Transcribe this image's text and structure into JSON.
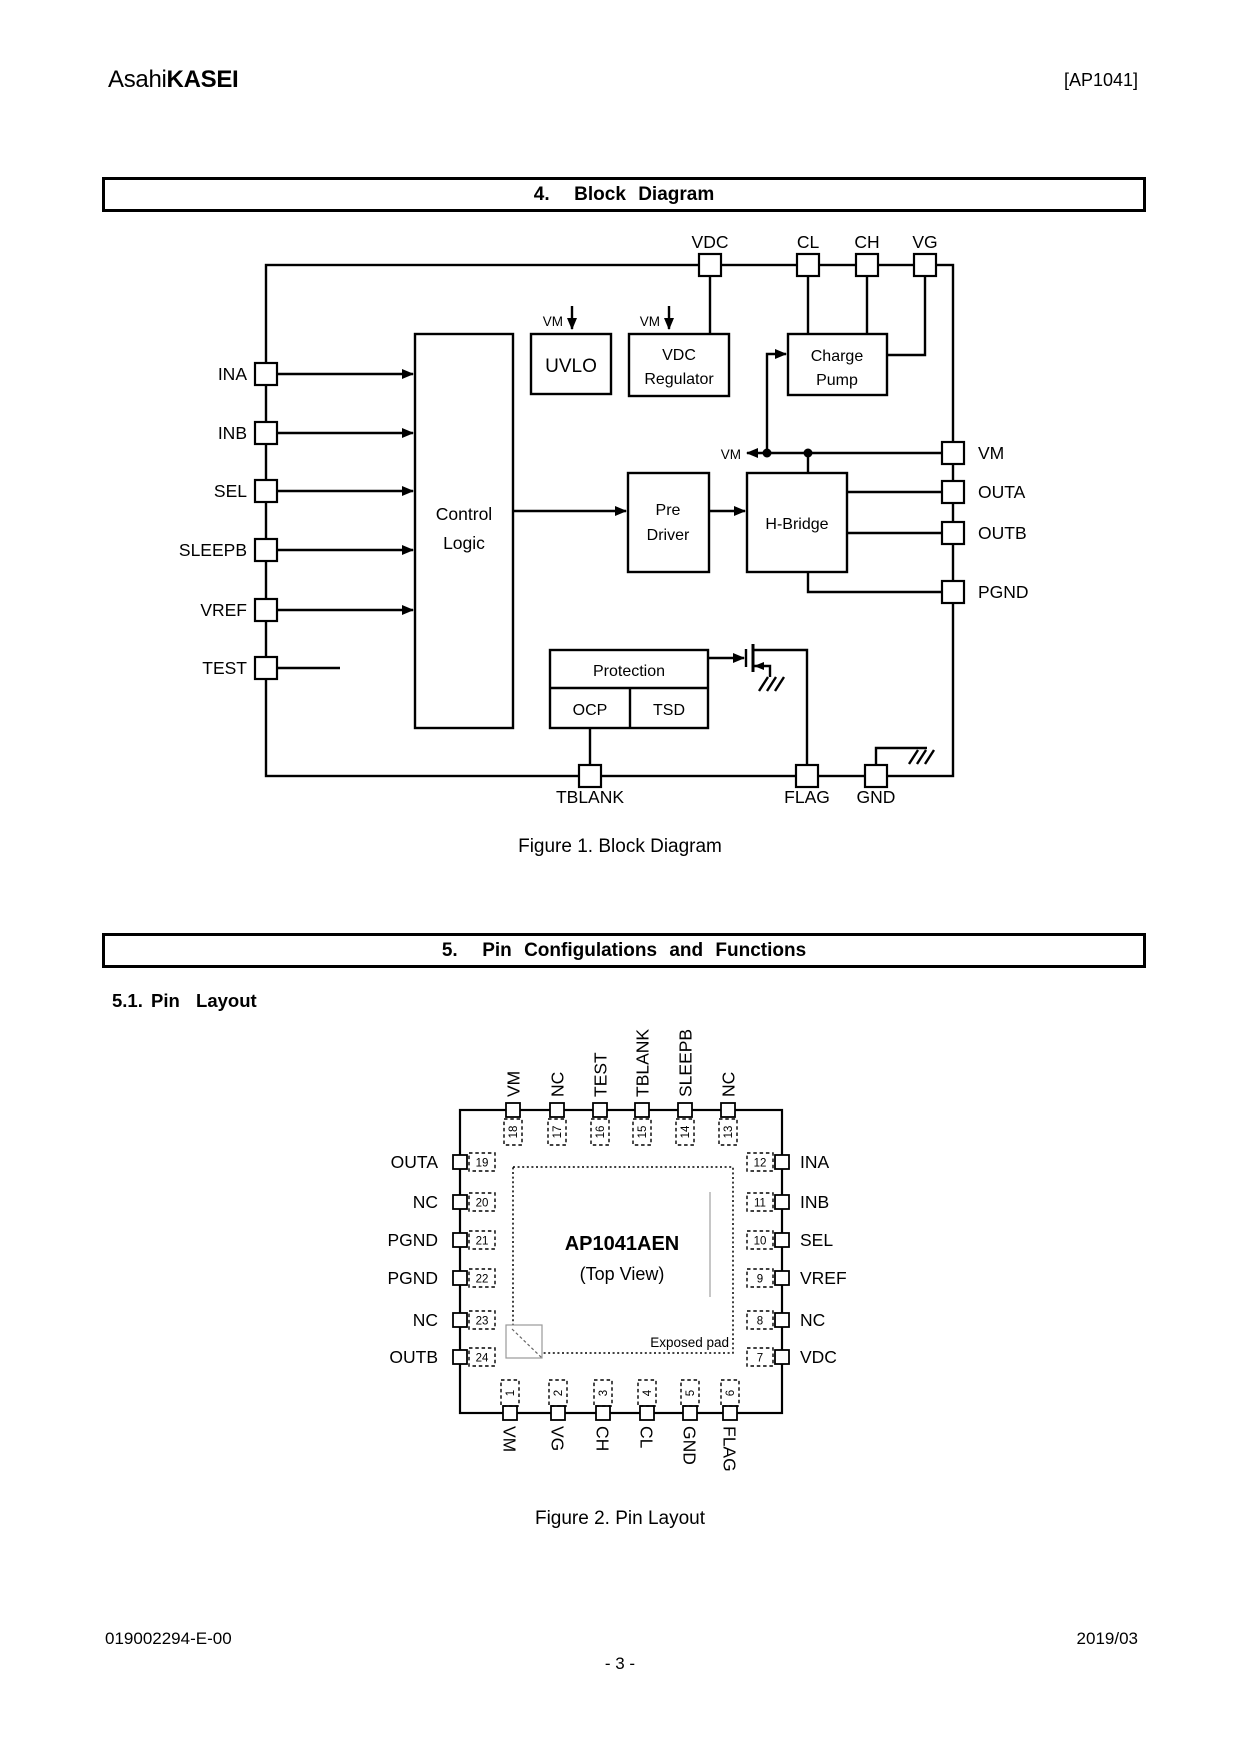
{
  "header": {
    "brand_light": "Asahi",
    "brand_bold": "KASEI",
    "doc_id": "[AP1041]"
  },
  "section4": {
    "title": "4.  Block Diagram"
  },
  "figure1": {
    "caption": "Figure 1. Block Diagram",
    "vm": "VM",
    "pins": {
      "top": [
        "VDC",
        "CL",
        "CH",
        "VG"
      ],
      "left": [
        "INA",
        "INB",
        "SEL",
        "SLEEPB",
        "VREF",
        "TEST"
      ],
      "right": [
        "VM",
        "OUTA",
        "OUTB",
        "PGND"
      ],
      "bottom": [
        "TBLANK",
        "FLAG",
        "GND"
      ]
    },
    "blocks": {
      "control1": "Control",
      "control2": "Logic",
      "uvlo": "UVLO",
      "vdcreg1": "VDC",
      "vdcreg2": "Regulator",
      "pump1": "Charge",
      "pump2": "Pump",
      "pre1": "Pre",
      "pre2": "Driver",
      "hbridge": "H-Bridge",
      "protection": "Protection",
      "ocp": "OCP",
      "tsd": "TSD"
    }
  },
  "section5": {
    "title": "5.  Pin Configulations and Functions",
    "subtitle": "5.1. Pin  Layout"
  },
  "figure2": {
    "caption": "Figure 2. Pin Layout",
    "chip_name": "AP1041AEN",
    "view_label": "(Top View)",
    "exposed_pad": "Exposed pad",
    "top": [
      {
        "n": "18",
        "label": "VM"
      },
      {
        "n": "17",
        "label": "NC"
      },
      {
        "n": "16",
        "label": "TEST"
      },
      {
        "n": "15",
        "label": "TBLANK"
      },
      {
        "n": "14",
        "label": "SLEEPB"
      },
      {
        "n": "13",
        "label": "NC"
      }
    ],
    "left": [
      {
        "n": "19",
        "label": "OUTA"
      },
      {
        "n": "20",
        "label": "NC"
      },
      {
        "n": "21",
        "label": "PGND"
      },
      {
        "n": "22",
        "label": "PGND"
      },
      {
        "n": "23",
        "label": "NC"
      },
      {
        "n": "24",
        "label": "OUTB"
      }
    ],
    "right": [
      {
        "n": "12",
        "label": "INA"
      },
      {
        "n": "11",
        "label": "INB"
      },
      {
        "n": "10",
        "label": "SEL"
      },
      {
        "n": "9",
        "label": "VREF"
      },
      {
        "n": "8",
        "label": "NC"
      },
      {
        "n": "7",
        "label": "VDC"
      }
    ],
    "bottom": [
      {
        "n": "1",
        "label": "VM"
      },
      {
        "n": "2",
        "label": "VG"
      },
      {
        "n": "3",
        "label": "CH"
      },
      {
        "n": "4",
        "label": "CL"
      },
      {
        "n": "5",
        "label": "GND"
      },
      {
        "n": "6",
        "label": "FLAG"
      }
    ]
  },
  "footer": {
    "doc_number": "019002294-E-00",
    "date": "2019/03",
    "page": "- 3 -"
  }
}
